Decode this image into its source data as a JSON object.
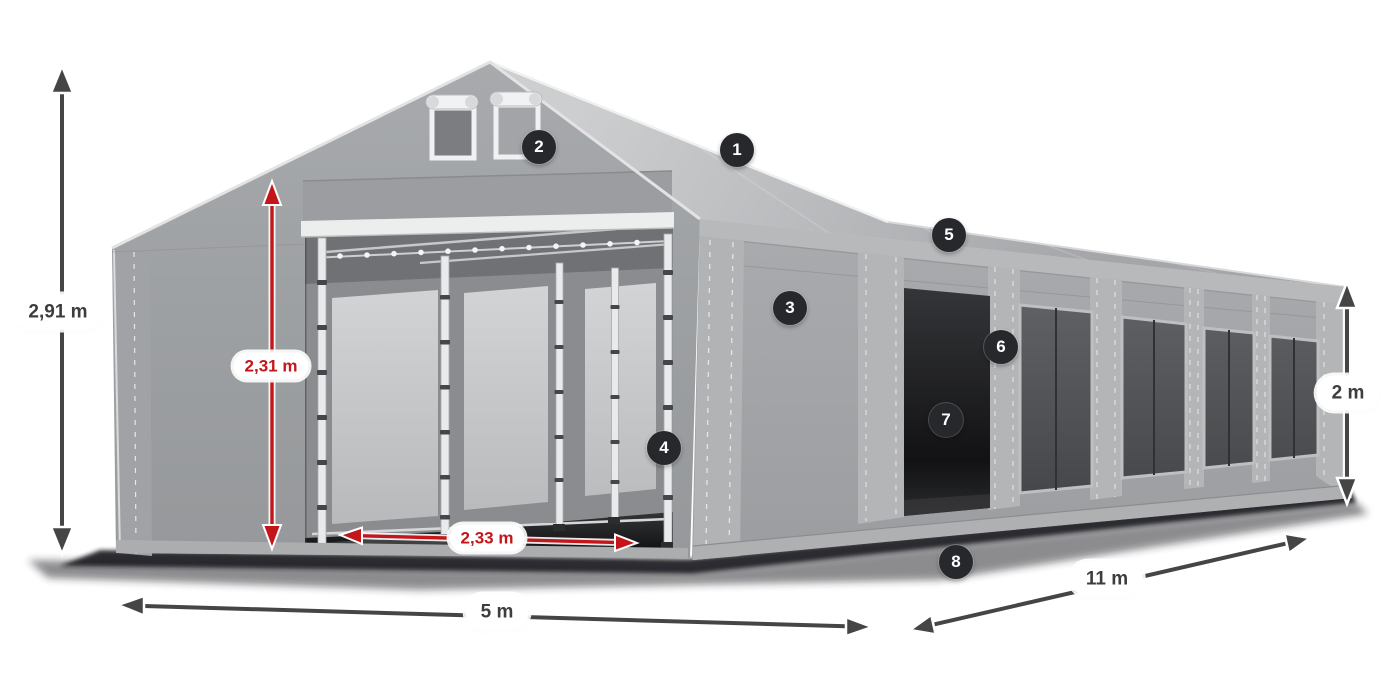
{
  "measurements": {
    "total_height": {
      "text": "2,91 m"
    },
    "entrance_height": {
      "text": "2,31 m"
    },
    "entrance_width": {
      "text": "2,33 m"
    },
    "front_width": {
      "text": "5 m"
    },
    "side_length": {
      "text": "11 m"
    },
    "side_wall_height": {
      "text": "2 m"
    }
  },
  "callouts": {
    "labels": [
      "1",
      "2",
      "3",
      "4",
      "5",
      "6",
      "7",
      "8"
    ]
  },
  "colors": {
    "dimension_red": "#c3161b",
    "dimension_dark": "#454545",
    "badge_background": "#26282c",
    "badge_text": "#ffffff",
    "label_background": "#ffffff",
    "label_text": "#3d3d3d"
  }
}
